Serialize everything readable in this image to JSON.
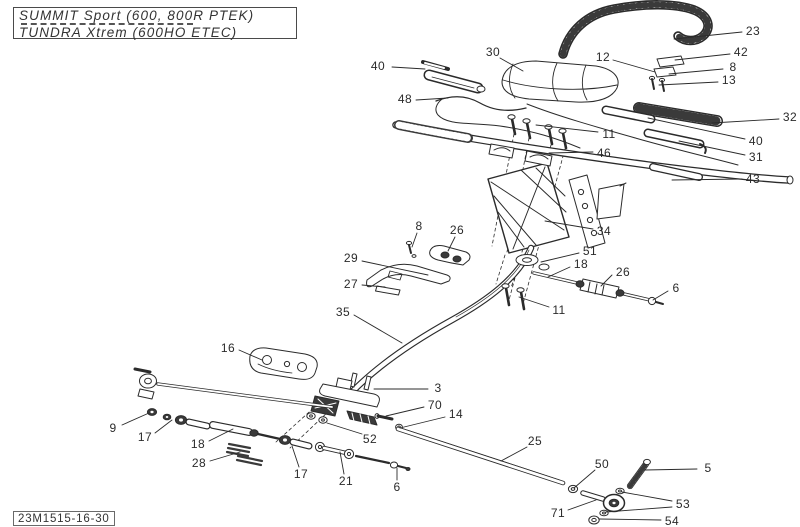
{
  "page": {
    "paper_color": "#ffffff",
    "ink_color": "#2b2b2b",
    "dark_fill_color": "#3a3a3a"
  },
  "header": {
    "model_box": {
      "line1": "SUMMIT Sport (600, 800R PTEK)",
      "line2": "TUNDRA Xtrem (600HO ETEC)"
    }
  },
  "footer": {
    "sheet_code": "23M1515-16-30"
  },
  "diagram": {
    "callouts": [
      {
        "label": "40",
        "x": 378,
        "y": 66,
        "leaders": [
          [
            392,
            67,
            425,
            69
          ]
        ]
      },
      {
        "label": "30",
        "x": 493,
        "y": 52,
        "leaders": [
          [
            500,
            58,
            523,
            71
          ]
        ]
      },
      {
        "label": "48",
        "x": 405,
        "y": 99,
        "leaders": [
          [
            416,
            100,
            448,
            98
          ]
        ]
      },
      {
        "label": "23",
        "x": 753,
        "y": 31,
        "leaders": [
          [
            742,
            32,
            674,
            39
          ]
        ]
      },
      {
        "label": "12",
        "x": 603,
        "y": 57,
        "leaders": [
          [
            613,
            60,
            655,
            72
          ]
        ]
      },
      {
        "label": "42",
        "x": 741,
        "y": 52,
        "leaders": [
          [
            730,
            54,
            675,
            60
          ]
        ]
      },
      {
        "label": "8",
        "x": 733,
        "y": 67,
        "leaders": [
          [
            723,
            69,
            669,
            74
          ]
        ]
      },
      {
        "label": "13",
        "x": 729,
        "y": 80,
        "leaders": [
          [
            718,
            82,
            659,
            85
          ]
        ]
      },
      {
        "label": "32",
        "x": 790,
        "y": 117,
        "leaders": [
          [
            779,
            119,
            712,
            123
          ]
        ]
      },
      {
        "label": "11",
        "x": 609,
        "y": 134,
        "leaders": [
          [
            598,
            132,
            536,
            125
          ]
        ]
      },
      {
        "label": "40",
        "x": 756,
        "y": 141,
        "leaders": [
          [
            745,
            139,
            648,
            118
          ]
        ]
      },
      {
        "label": "46",
        "x": 604,
        "y": 153,
        "leaders": [
          [
            593,
            152,
            549,
            153
          ]
        ]
      },
      {
        "label": "31",
        "x": 756,
        "y": 157,
        "leaders": [
          [
            745,
            155,
            679,
            141
          ]
        ]
      },
      {
        "label": "43",
        "x": 753,
        "y": 179,
        "leaders": [
          [
            742,
            179,
            672,
            180
          ]
        ]
      },
      {
        "label": "34",
        "x": 604,
        "y": 231,
        "leaders": [
          [
            593,
            229,
            545,
            221
          ]
        ]
      },
      {
        "label": "8",
        "x": 419,
        "y": 226,
        "leaders": [
          [
            417,
            233,
            412,
            247
          ]
        ]
      },
      {
        "label": "26",
        "x": 457,
        "y": 230,
        "leaders": [
          [
            455,
            237,
            448,
            251
          ]
        ]
      },
      {
        "label": "29",
        "x": 351,
        "y": 258,
        "leaders": [
          [
            362,
            261,
            428,
            275
          ]
        ]
      },
      {
        "label": "27",
        "x": 351,
        "y": 284,
        "leaders": [
          [
            362,
            285,
            385,
            287
          ]
        ]
      },
      {
        "label": "35",
        "x": 343,
        "y": 312,
        "leaders": [
          [
            354,
            315,
            402,
            343
          ]
        ]
      },
      {
        "label": "51",
        "x": 590,
        "y": 251,
        "leaders": [
          [
            579,
            253,
            541,
            262
          ]
        ]
      },
      {
        "label": "18",
        "x": 581,
        "y": 264,
        "leaders": [
          [
            570,
            267,
            548,
            277
          ]
        ]
      },
      {
        "label": "26",
        "x": 623,
        "y": 272,
        "leaders": [
          [
            612,
            275,
            601,
            286
          ]
        ]
      },
      {
        "label": "6",
        "x": 676,
        "y": 288,
        "leaders": [
          [
            668,
            291,
            653,
            300
          ]
        ]
      },
      {
        "label": "11",
        "x": 559,
        "y": 310,
        "leaders": [
          [
            549,
            307,
            519,
            297
          ]
        ]
      },
      {
        "label": "16",
        "x": 228,
        "y": 348,
        "leaders": [
          [
            239,
            350,
            262,
            360
          ]
        ]
      },
      {
        "label": "3",
        "x": 438,
        "y": 388,
        "leaders": [
          [
            428,
            389,
            374,
            389
          ]
        ]
      },
      {
        "label": "70",
        "x": 435,
        "y": 405,
        "leaders": [
          [
            424,
            407,
            386,
            416
          ]
        ]
      },
      {
        "label": "14",
        "x": 456,
        "y": 414,
        "leaders": [
          [
            445,
            417,
            400,
            428
          ]
        ]
      },
      {
        "label": "52",
        "x": 370,
        "y": 439,
        "leaders": [
          [
            362,
            434,
            327,
            423
          ]
        ]
      },
      {
        "label": "9",
        "x": 113,
        "y": 428,
        "leaders": [
          [
            122,
            425,
            149,
            413
          ]
        ]
      },
      {
        "label": "17",
        "x": 145,
        "y": 437,
        "leaders": [
          [
            155,
            433,
            172,
            420
          ]
        ]
      },
      {
        "label": "18",
        "x": 198,
        "y": 444,
        "leaders": [
          [
            209,
            441,
            233,
            429
          ]
        ]
      },
      {
        "label": "28",
        "x": 199,
        "y": 463,
        "leaders": [
          [
            210,
            461,
            240,
            452
          ]
        ]
      },
      {
        "label": "17",
        "x": 301,
        "y": 474,
        "leaders": [
          [
            299,
            467,
            292,
            446
          ]
        ]
      },
      {
        "label": "21",
        "x": 346,
        "y": 481,
        "leaders": [
          [
            344,
            474,
            340,
            452
          ]
        ]
      },
      {
        "label": "6",
        "x": 397,
        "y": 487,
        "leaders": [
          [
            397,
            480,
            397,
            468
          ]
        ]
      },
      {
        "label": "25",
        "x": 535,
        "y": 441,
        "leaders": [
          [
            527,
            447,
            501,
            461
          ]
        ]
      },
      {
        "label": "50",
        "x": 602,
        "y": 464,
        "leaders": [
          [
            595,
            470,
            574,
            488
          ]
        ]
      },
      {
        "label": "5",
        "x": 708,
        "y": 468,
        "leaders": [
          [
            697,
            469,
            645,
            470
          ]
        ]
      },
      {
        "label": "71",
        "x": 558,
        "y": 513,
        "leaders": [
          [
            568,
            510,
            596,
            500
          ]
        ]
      },
      {
        "label": "53",
        "x": 683,
        "y": 504,
        "leaders": [
          [
            672,
            501,
            622,
            492
          ],
          [
            672,
            507,
            606,
            512
          ]
        ]
      },
      {
        "label": "54",
        "x": 672,
        "y": 521,
        "leaders": [
          [
            661,
            520,
            599,
            519
          ]
        ]
      }
    ]
  }
}
